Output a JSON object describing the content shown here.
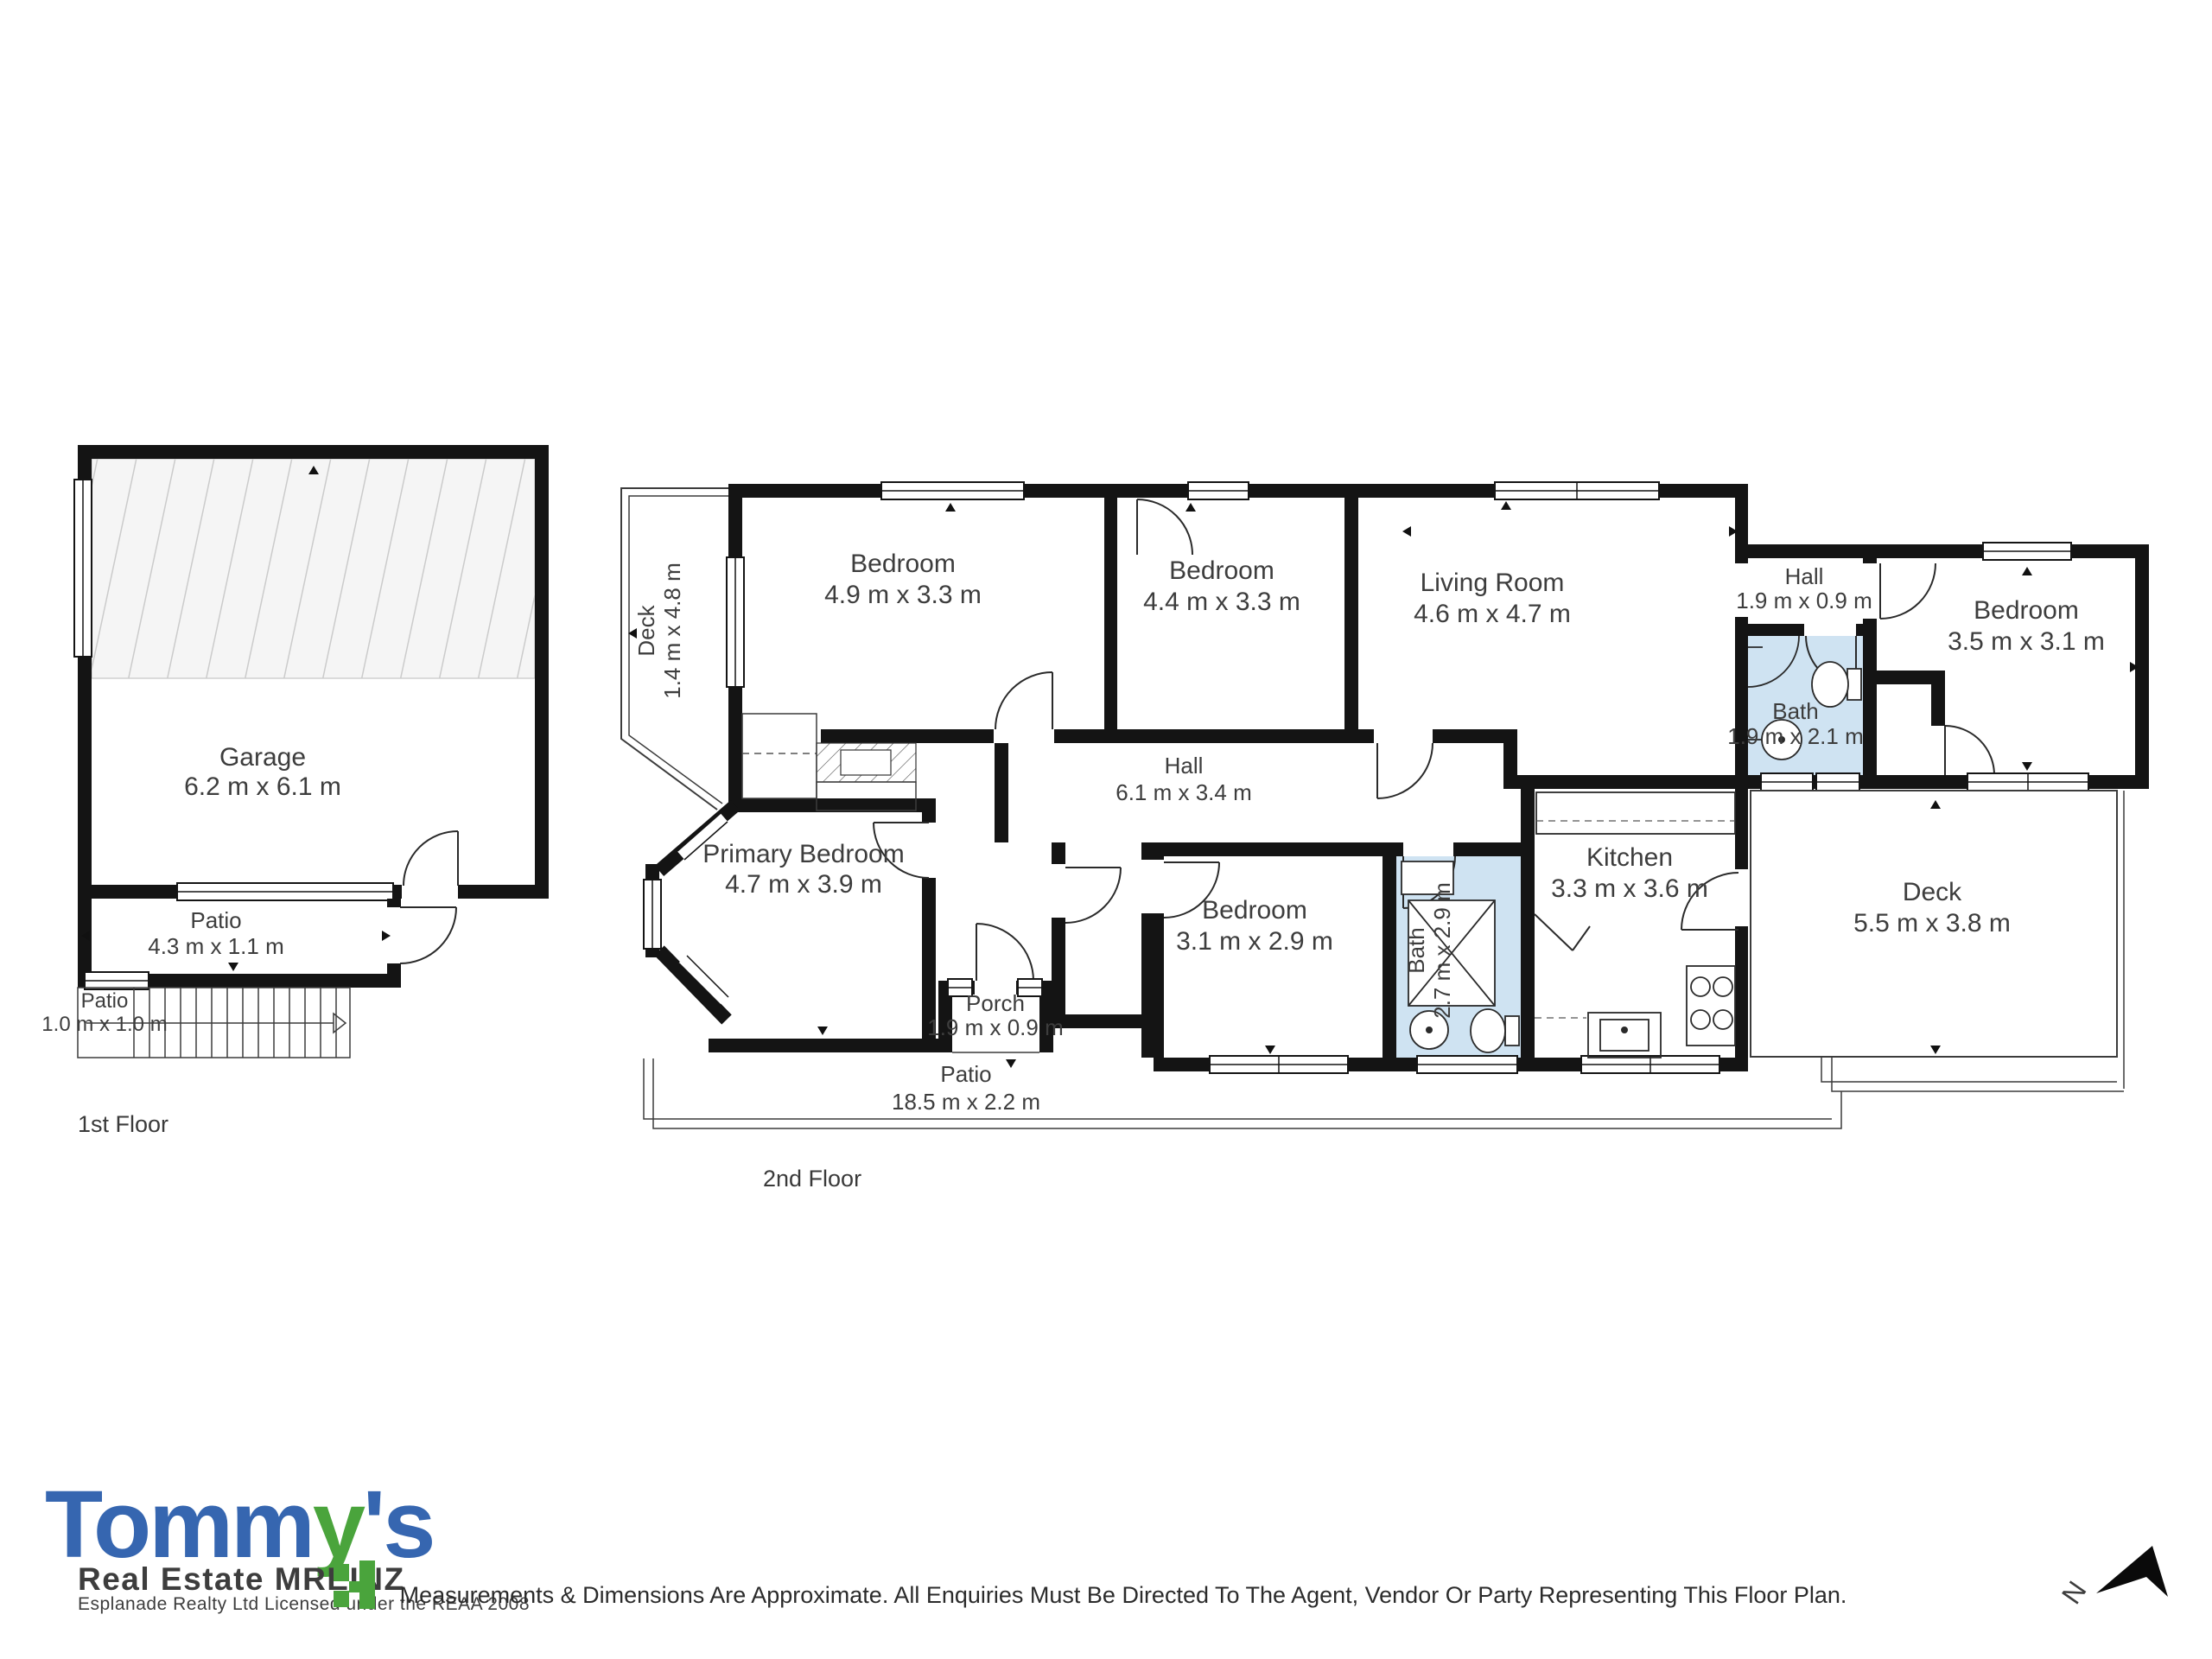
{
  "floor1": {
    "title": "1st Floor",
    "garage": {
      "label": "Garage",
      "dims": "6.2 m x 6.1 m"
    },
    "patio_a": {
      "label": "Patio",
      "dims": "4.3 m x 1.1 m"
    },
    "patio_b": {
      "label": "Patio",
      "dims": "1.0 m x 1.0 m"
    }
  },
  "floor2": {
    "title": "2nd Floor",
    "deck_left": {
      "label": "Deck",
      "dims": "1.4 m x 4.8 m"
    },
    "bedroom_a": {
      "label": "Bedroom",
      "dims": "4.9 m x 3.3 m"
    },
    "bedroom_b": {
      "label": "Bedroom",
      "dims": "4.4 m x 3.3 m"
    },
    "living": {
      "label": "Living Room",
      "dims": "4.6 m x 4.7 m"
    },
    "hall_small": {
      "label": "Hall",
      "dims": "1.9 m x 0.9 m"
    },
    "bath_small": {
      "label": "Bath",
      "dims": "1.9 m x 2.1 m"
    },
    "bedroom_c": {
      "label": "Bedroom",
      "dims": "3.5 m x 3.1 m"
    },
    "hall_main": {
      "label": "Hall",
      "dims": "6.1 m x 3.4 m"
    },
    "primary": {
      "label": "Primary Bedroom",
      "dims": "4.7 m x 3.9 m"
    },
    "bedroom_d": {
      "label": "Bedroom",
      "dims": "3.1 m x 2.9 m"
    },
    "bath_main": {
      "label": "Bath",
      "dims": "2.7 m x 2.9 m"
    },
    "kitchen": {
      "label": "Kitchen",
      "dims": "3.3 m x 3.6 m"
    },
    "deck_right": {
      "label": "Deck",
      "dims": "5.5 m x 3.8 m"
    },
    "porch": {
      "label": "Porch",
      "dims": "1.9 m x 0.9 m"
    },
    "patio_long": {
      "label": "Patio",
      "dims": "18.5 m x 2.2 m"
    }
  },
  "footer": {
    "disclaimer": "Measurements & Dimensions Are Approximate. All Enquiries Must Be Directed To The Agent, Vendor Or Party Representing This Floor Plan."
  },
  "compass": {
    "n": "N"
  },
  "logo": {
    "word_main": "Tomm",
    "word_green": "y",
    "word_apos": "'s",
    "line2": "Real Estate MREINZ",
    "line3": "Esplanade Realty Ltd Licensed under the REAA 2008",
    "blue": "#3666b0",
    "green": "#4aa43c"
  },
  "colors": {
    "wall": "#141414",
    "bath_fill": "#cfe3f2"
  }
}
